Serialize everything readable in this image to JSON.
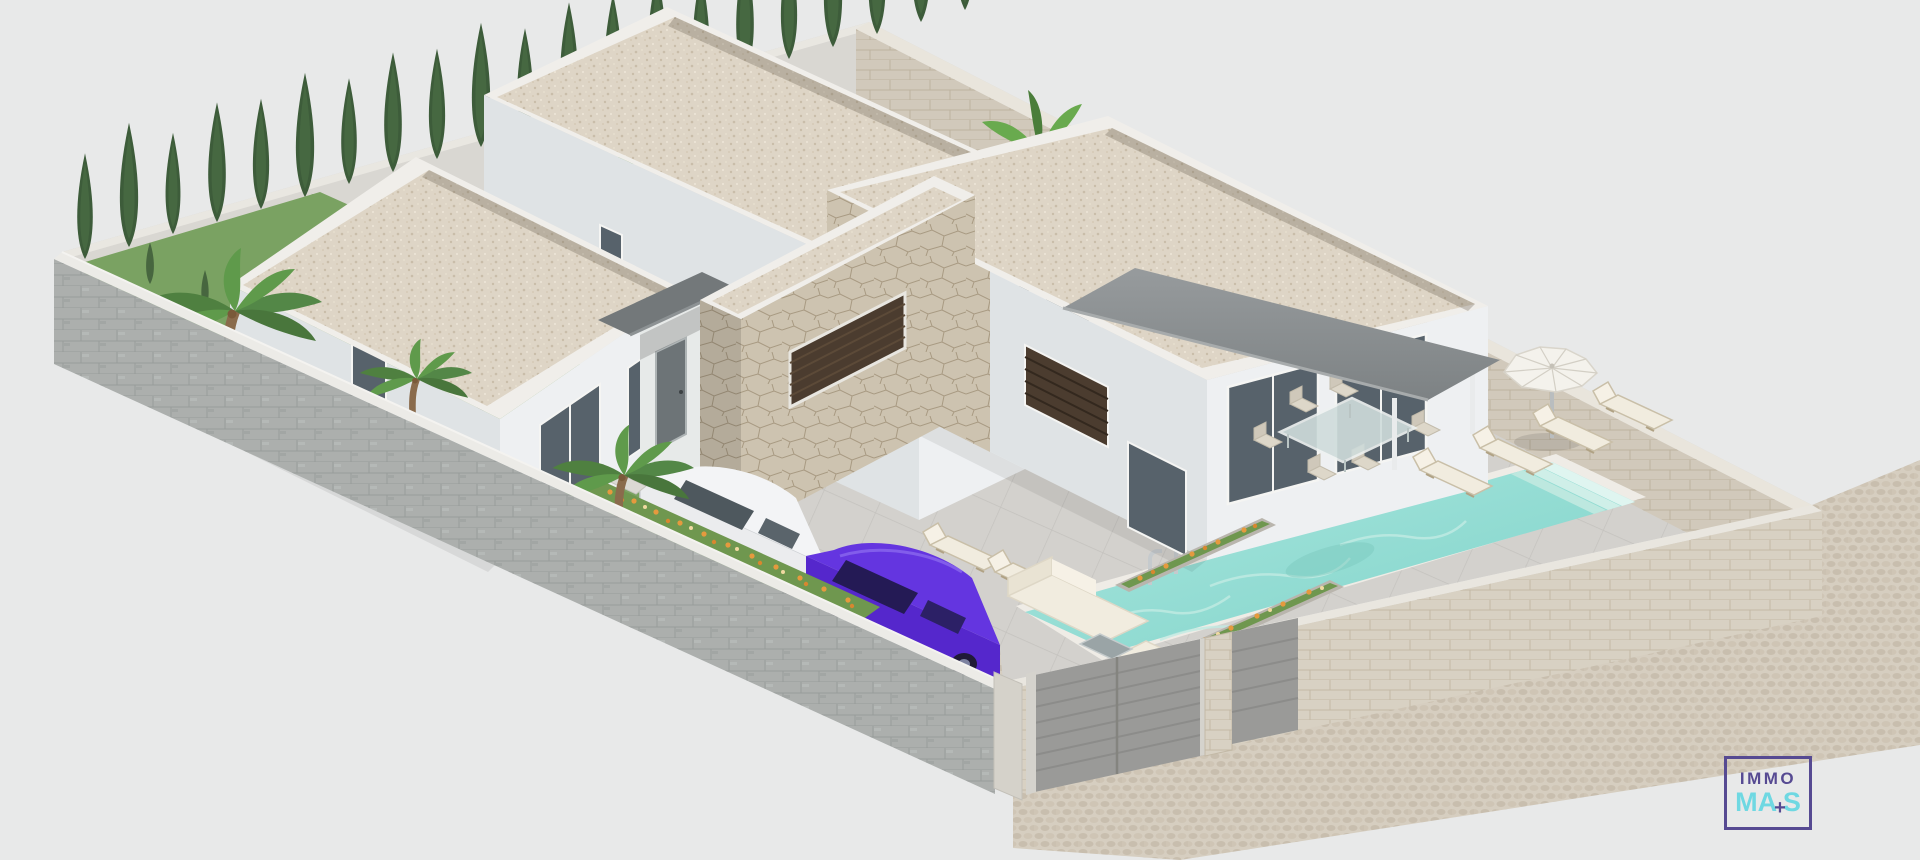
{
  "scene": {
    "type": "architectural-3d-render",
    "view": "aerial isometric",
    "subject": "Modern single-storey villa on a walled corner plot with flat gravel roofs, natural-stone feature wall, covered terrace with awning, rectangular swimming pool, sun loungers, white parasol, outdoor dining set, lounge sofa, two parked cars, palm trees, cypress hedge and flower beds",
    "objects": [
      "perimeter-block-wall",
      "perimeter-stone-wall",
      "driveway-gate",
      "pedestrian-gate",
      "rear-building",
      "left-building",
      "main-building",
      "stone-feature-wall",
      "entrance-porch",
      "canopy",
      "awning",
      "swimming-pool",
      "pool-ladder",
      "pool-steps",
      "parasol",
      "sun-loungers",
      "dining-set",
      "outdoor-sofa",
      "white-car",
      "purple-car",
      "palm-trees",
      "cypress-hedge",
      "banana-plants",
      "flower-beds",
      "planters",
      "stepping-stones",
      "sidewalk"
    ]
  },
  "palette": {
    "bg": "#e8e9e9",
    "terrace": "#d3d1cd",
    "tile_line": "#c4c2be",
    "gravel": "#ded5c6",
    "gravel_dot": "#c9bda9",
    "parapet": "#f0eeea",
    "wall_lit": "#eef0f2",
    "wall_shade": "#dfe3e5",
    "stone": "#cdc3b0",
    "stone_line": "#a89a82",
    "block_wall": "#b3b7b5",
    "block_line": "#9fa3a1",
    "course_wall": "#d8d1c3",
    "course_line": "#c3b9a6",
    "cobble": "#d6cec0",
    "cobble_dot": "#c8beae",
    "coping": "#efece6",
    "pool_deep": "#7fd3c9",
    "pool_light": "#a9e6de",
    "pool_ripple": "#c2ebe3",
    "grass": "#7aa262",
    "cypress": "#3d5c3a",
    "hedge": "#47663f",
    "palm_leaf": "#5f9149",
    "trunk": "#8a6b4c",
    "flower_orange": "#e59a3e",
    "flower_amber": "#d8872f",
    "flower_cream": "#f0d9a0",
    "awning_dark": "#7d8284",
    "awning_light": "#979b9d",
    "canopy_gray": "#73787a",
    "glass_dark": "#57626b",
    "louver_brown": "#4b3c2f",
    "gate_gray": "#9a9a98",
    "car_white": "#ebecee",
    "car_purple": "#5527cc",
    "car_glass": "#241a55",
    "chrome": "#c5cacd",
    "cushion": "#f1ecdf",
    "wood_frame": "#c9bfa8",
    "logo_purple": "#564a92",
    "logo_cyan": "#6fd8e2"
  },
  "watermark": {
    "line1": "IMMO",
    "line2_start": "MA",
    "plus": "+",
    "line2_end": "S"
  }
}
